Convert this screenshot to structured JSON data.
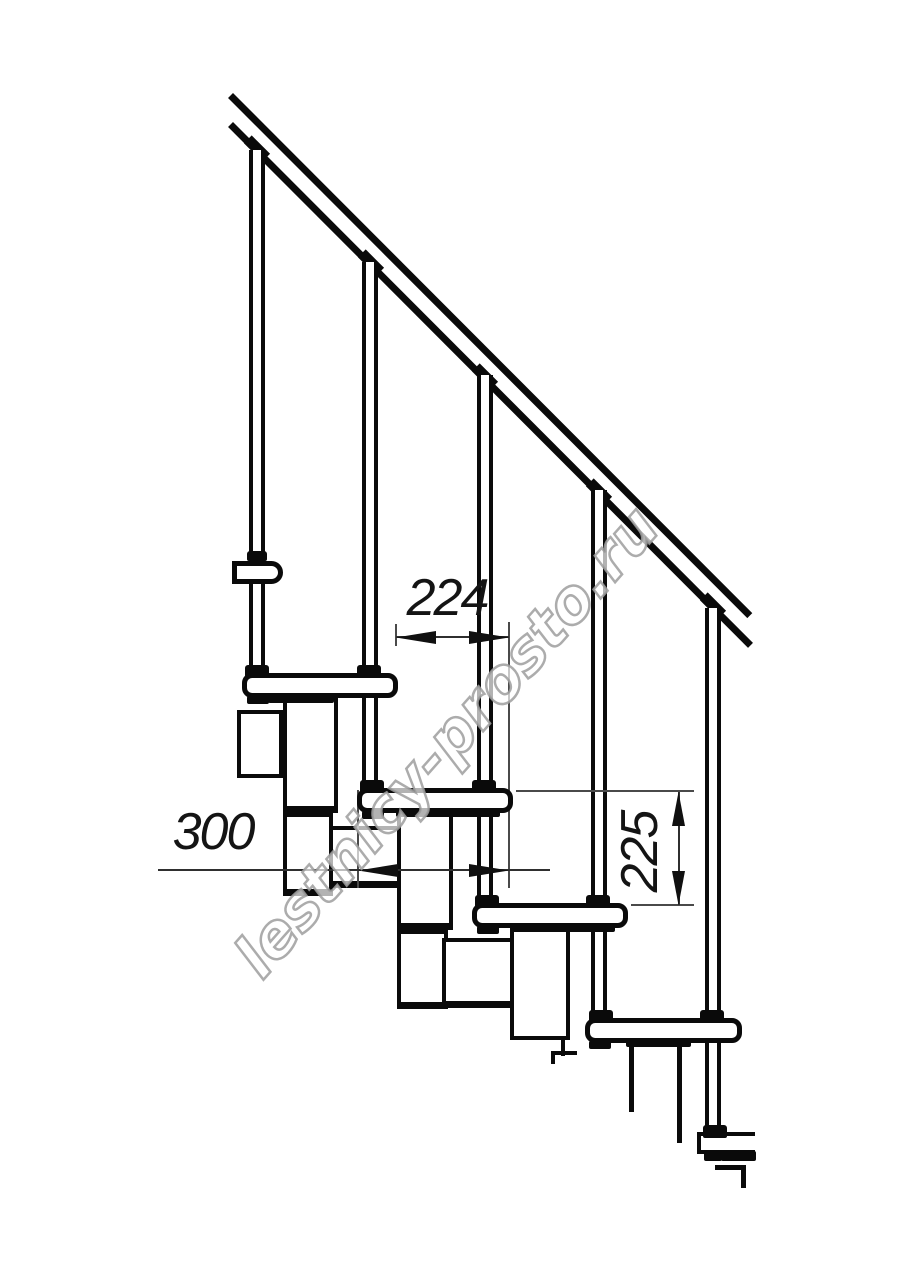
{
  "figure": {
    "kind": "technical-line-drawing",
    "subject": "modular staircase side section with handrail, balusters, treads and support modules"
  },
  "watermark": {
    "text": "lestnicy-prosto.ru"
  },
  "dimensions": {
    "step_run": "224",
    "tread_depth": "300",
    "step_rise": "225"
  },
  "colors": {
    "ink": "#0a0a0a",
    "dimension_lines": "#4a4a4a",
    "watermark_outline": "#9e9e9e",
    "background": "#ffffff"
  }
}
